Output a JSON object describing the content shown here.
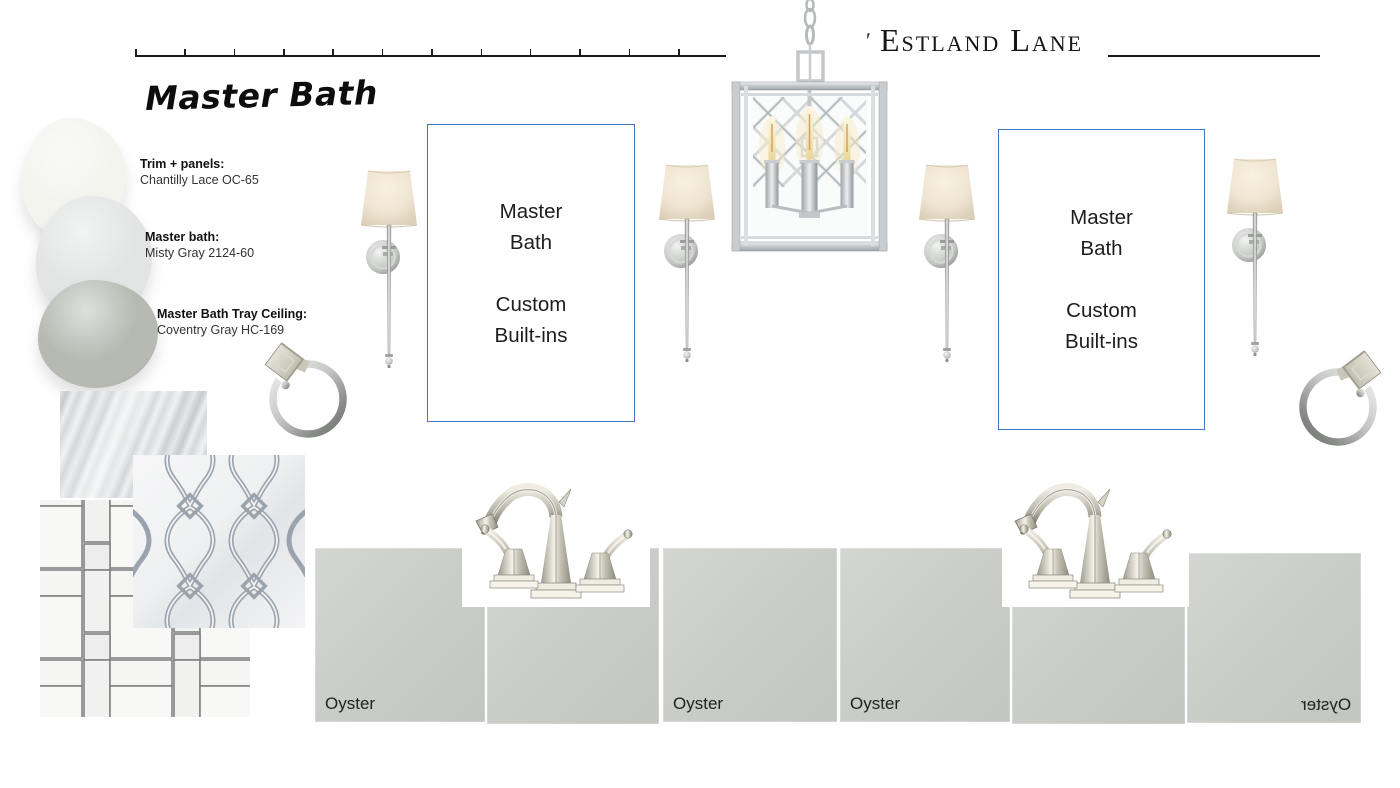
{
  "header": {
    "title_mark": "ʹ",
    "title": "Estland Lane"
  },
  "section_title": "Master Bath",
  "paint_swatches": [
    {
      "label": "Trim + panels:",
      "name": "Chantilly Lace OC-65",
      "color": "#f3f4ee"
    },
    {
      "label": "Master bath:",
      "name": "Misty Gray 2124-60",
      "color": "#e2e5e3"
    },
    {
      "label": "Master Bath Tray Ceiling:",
      "name": "Coventry Gray HC-169",
      "color": "#b6bab2"
    }
  ],
  "note_box": {
    "line1": "Master",
    "line2": "Bath",
    "line3": "Custom",
    "line4": "Built-ins",
    "border_color": "#4472c4"
  },
  "cabinet": {
    "finish_label": "Oyster",
    "panel_color": "#cacdc8"
  },
  "fixtures": {
    "chandelier": "lantern-chandelier",
    "sconce": "tail-sconce",
    "faucet": "widespread-faucet",
    "towel_ring": "towel-ring"
  },
  "tiles": {
    "slab": "gray-veined-marble-slab",
    "arabesque": "arabesque-mosaic-tile",
    "pinwheel": "pinwheel-mosaic-tile"
  }
}
